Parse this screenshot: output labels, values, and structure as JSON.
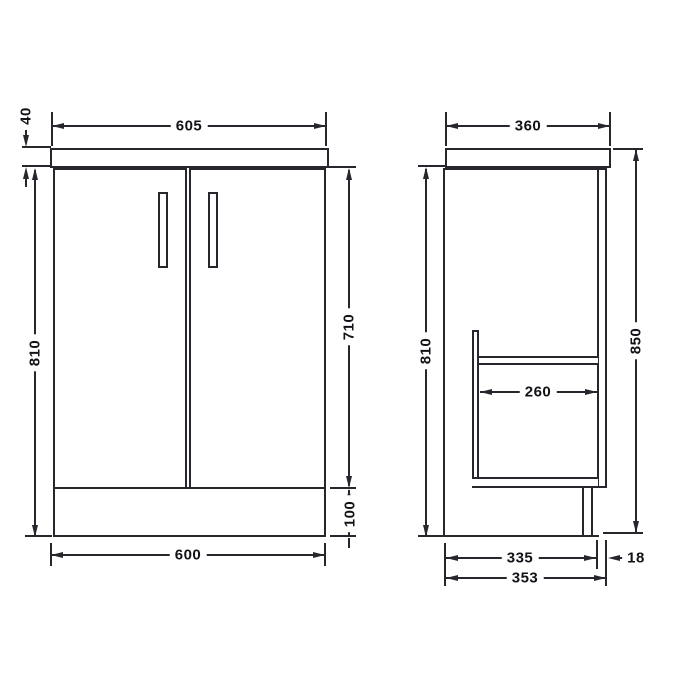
{
  "palette": {
    "background": "#ffffff",
    "line": "#26262c",
    "text": "#121219"
  },
  "front_view": {
    "dims": {
      "worktop_thickness": "40",
      "worktop_width": "605",
      "unit_height": "810",
      "door_height": "710",
      "plinth_height": "100",
      "cabinet_width": "600"
    }
  },
  "side_view": {
    "dims": {
      "worktop_depth": "360",
      "unit_height": "810",
      "overall_height": "850",
      "shelf_depth": "260",
      "carcass_depth": "335",
      "door_thickness": "18",
      "overall_depth": "353"
    }
  }
}
